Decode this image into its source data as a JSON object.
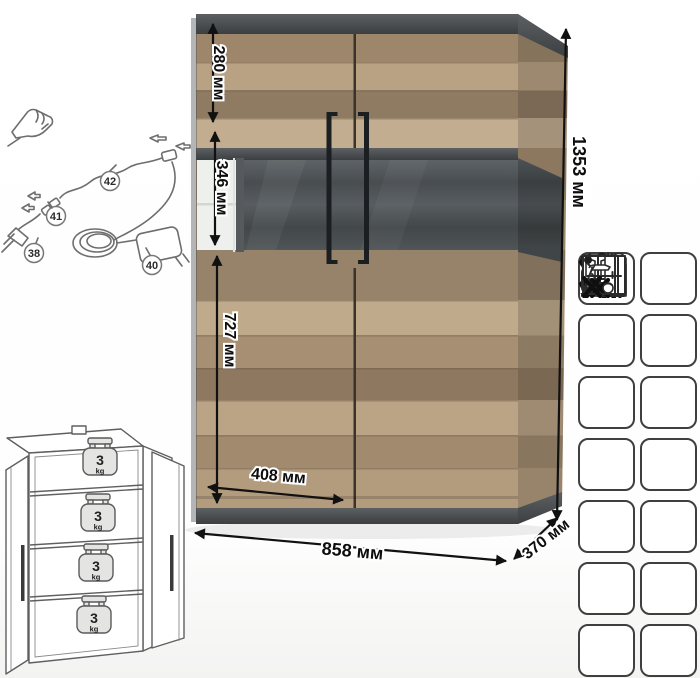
{
  "dimensions": {
    "height": "1353 мм",
    "width": "858 мм",
    "depth": "370 мм",
    "door_width": "408 мм",
    "top_section_height": "280 мм",
    "glass_section_height": "346 мм",
    "bottom_section_height": "727 мм"
  },
  "led_wiring": {
    "parts": {
      "strip_end": "38",
      "power_adapter": "40",
      "connector": "41",
      "cable": "42"
    }
  },
  "shelf_load": {
    "value": "3",
    "unit": "kg"
  },
  "care_icons": {
    "items": [
      {
        "name": "no-impact-tools"
      },
      {
        "name": "humidity-range",
        "text": "60-70%"
      },
      {
        "name": "no-sitting"
      },
      {
        "name": "no-standing"
      },
      {
        "name": "temperature-range",
        "text": "+10...+25°C"
      },
      {
        "name": "no-direct-sunlight"
      },
      {
        "name": "no-abrasive-cleaners"
      },
      {
        "name": "no-wet-cleaning"
      },
      {
        "name": "no-jumping-on-furniture"
      },
      {
        "name": "transport-position"
      },
      {
        "name": "keep-distance-from-heat",
        "text": "≥1M"
      },
      {
        "name": "ventilate-room",
        "text": "21"
      },
      {
        "name": "no-dragging"
      },
      {
        "name": "no-heavy-objects-inside"
      }
    ]
  },
  "colors": {
    "wood": "#b39c7e",
    "graphite": "#4c5052",
    "glass_back": "#4f5558",
    "handle": "#1c1f21"
  }
}
